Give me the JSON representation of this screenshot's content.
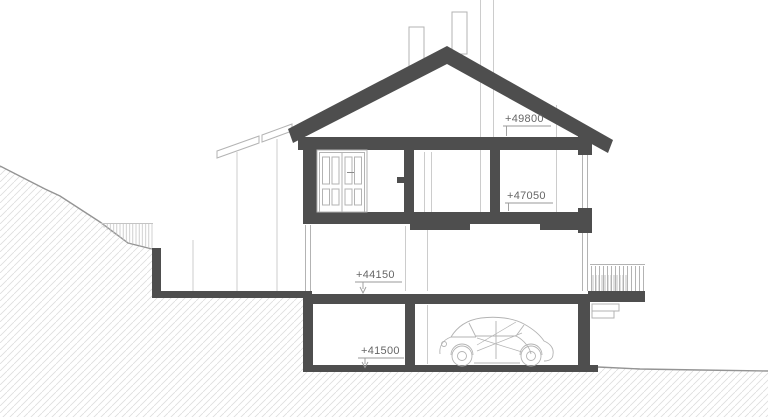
{
  "drawing": {
    "kind": "building cross-section drawing",
    "annotations": [
      {
        "name": "ridge-level",
        "label": "+49800"
      },
      {
        "name": "attic-floor-level",
        "label": "+47050"
      },
      {
        "name": "first-floor-level",
        "label": "+44150"
      },
      {
        "name": "basement-floor-level",
        "label": "+41500"
      }
    ],
    "colors": {
      "background": "#ffffff",
      "structure": "#4e4e4e",
      "outline": "#b3b3b3",
      "faint": "#cccccc",
      "terrain": "#949494",
      "hatch": "#dedede",
      "vegetation": "#c4c4c4",
      "text": "#666666",
      "marker": "#999999"
    }
  }
}
